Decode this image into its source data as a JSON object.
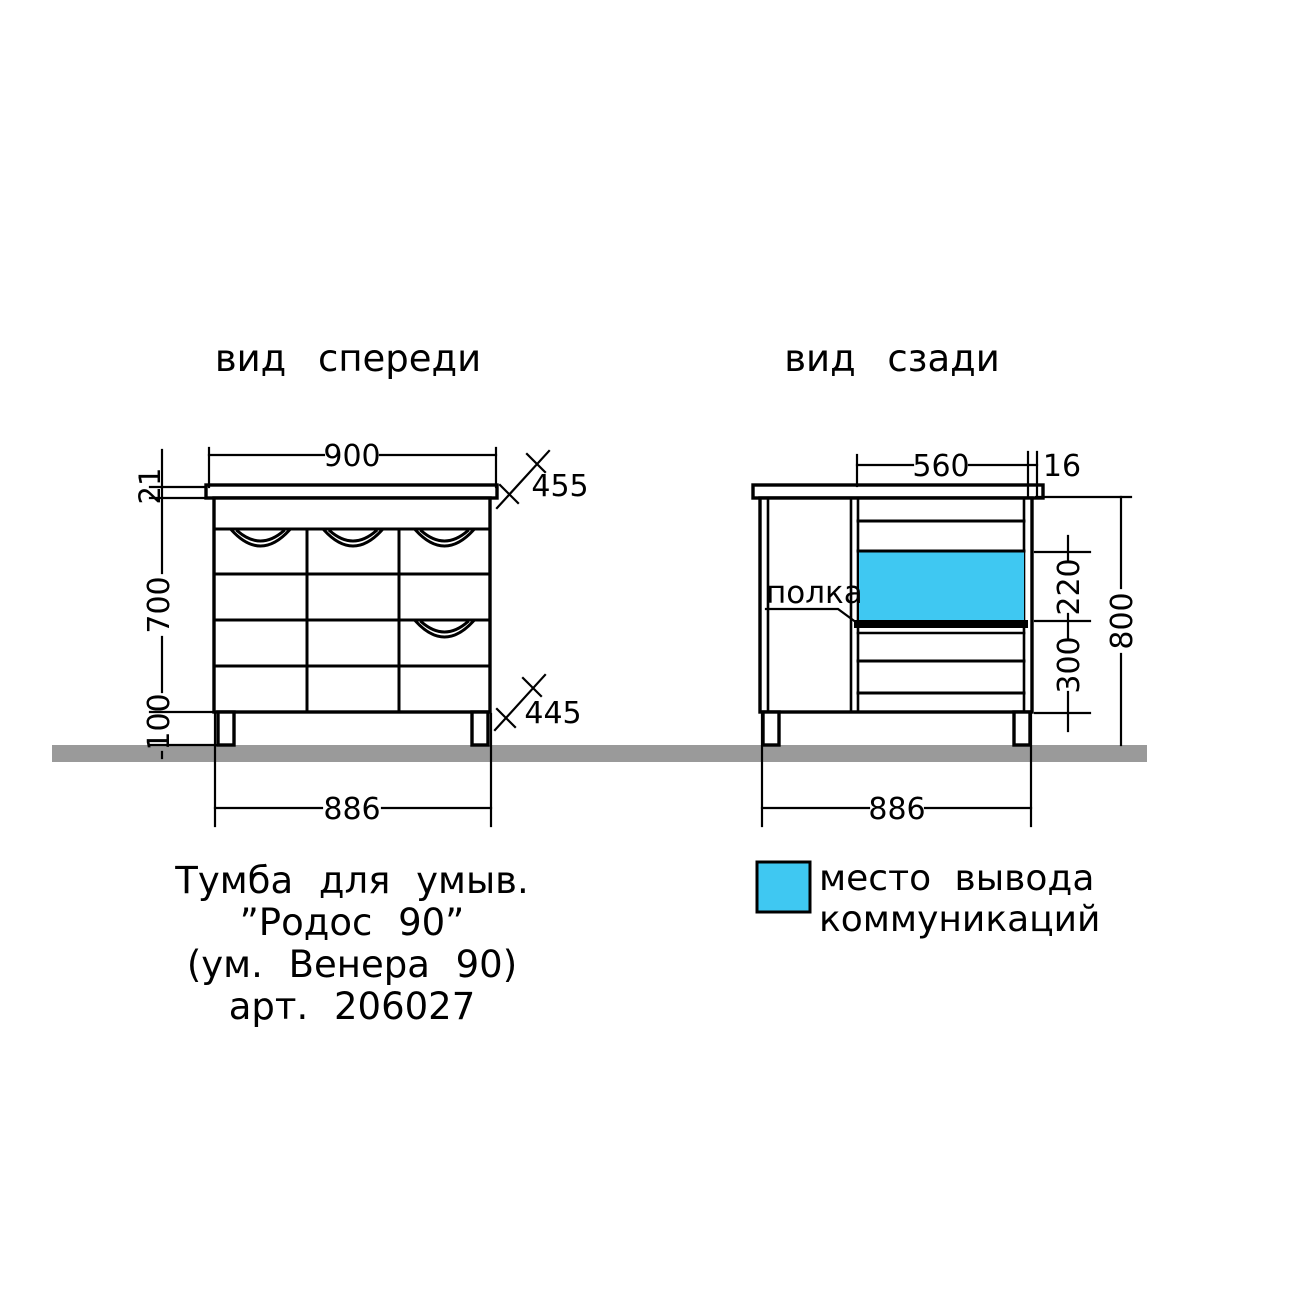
{
  "colors": {
    "line": "#000000",
    "floor": "#9a9a9a",
    "communication": "#3fc8f2"
  },
  "titles": {
    "front": "вид спереди",
    "back": "вид сзади"
  },
  "front": {
    "dim_top_width": "900",
    "dim_countertop_depth": "455",
    "dim_countertop_thickness": "21",
    "dim_body_height": "700",
    "dim_leg_height": "100",
    "dim_body_depth": "445",
    "dim_bottom_width": "886"
  },
  "back": {
    "dim_opening_width": "560",
    "dim_panel_thickness": "16",
    "dim_outlet_height": "220",
    "dim_lower_height": "300",
    "dim_total_height": "800",
    "dim_bottom_width": "886",
    "shelf_label": "полка"
  },
  "legend": {
    "swatch_color": "#3fc8f2",
    "line1": "место вывода",
    "line2": "коммуникаций"
  },
  "product": {
    "line1": "Тумба для умыв.",
    "line2": "”Родос 90”",
    "line3": "(ум. Венера 90)",
    "line4": "арт. 206027"
  }
}
